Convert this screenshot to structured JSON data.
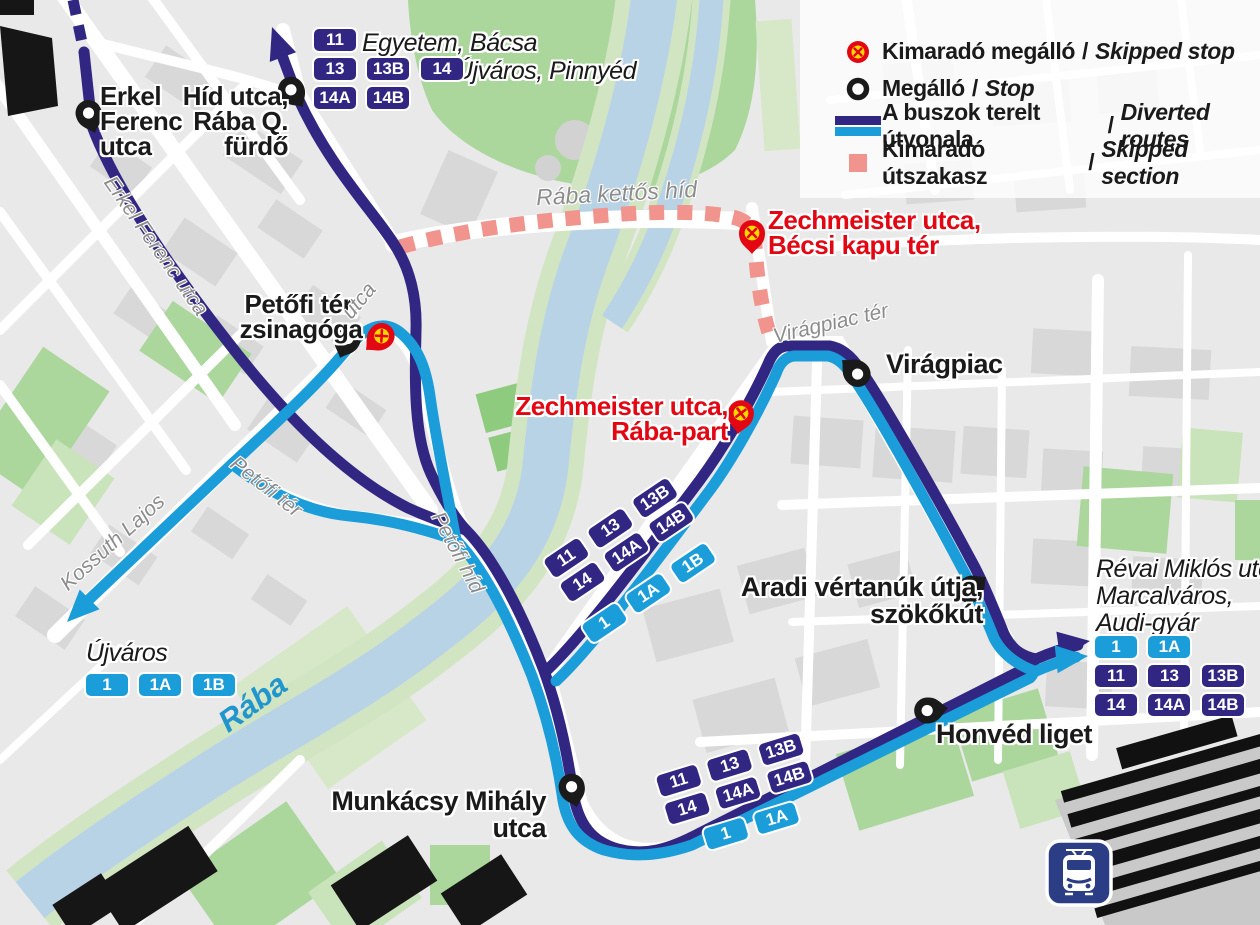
{
  "legend": {
    "sep": "/",
    "items": [
      {
        "hu": "Kimaradó megálló",
        "en": "Skipped stop"
      },
      {
        "hu": "Megálló",
        "en": "Stop"
      },
      {
        "hu": "A buszok terelt útvonala",
        "en": "Diverted routes"
      },
      {
        "hu": "Kimaradó útszakasz",
        "en": "Skipped section"
      }
    ]
  },
  "stops": {
    "erkel": {
      "lines": [
        "Erkel",
        "Ferenc",
        "utca"
      ]
    },
    "hid_utca": {
      "lines": [
        "Híd utca,",
        "Rába Q.",
        "fürdő"
      ]
    },
    "zsinagoga": {
      "lines": [
        "Petőfi tér,",
        "zsinagóga"
      ]
    },
    "viragpiac": {
      "label": "Virágpiac"
    },
    "aradi": {
      "lines": [
        "Aradi vértanúk útja,",
        "szökőkút"
      ]
    },
    "honved": {
      "label": "Honvéd liget"
    },
    "munkacsy": {
      "lines": [
        "Munkácsy Mihály",
        "utca"
      ]
    }
  },
  "skipped_stops": {
    "becsi_kapu": {
      "lines": [
        "Zechmeister utca,",
        "Bécsi kapu tér"
      ]
    },
    "raba_part": {
      "lines": [
        "Zechmeister utca,",
        "Rába-part"
      ]
    }
  },
  "destinations": {
    "north1": "Egyetem, Bácsa",
    "north2": "Újváros, Pinnyéd",
    "southwest": "Újváros",
    "east": {
      "lines": [
        "Révai Miklós utca,",
        "Marcalváros,",
        "Audi-gyár"
      ]
    }
  },
  "street_labels": {
    "erkel_ferenc": "Erkel Ferenc utca",
    "raba_kettos_hid": "Rába kettős híd",
    "viragpiac_ter": "Virágpiac tér",
    "petofi_ter": "Petőfi tér",
    "kossuth_lajos": "Kossuth Lajos",
    "petofi_hid": "Petőfi híd",
    "utca": "utca",
    "river": "Rába"
  },
  "badges": {
    "top": {
      "row1": [
        "11"
      ],
      "row2": [
        "13",
        "13B",
        "14"
      ],
      "row3": [
        "14A",
        "14B"
      ]
    },
    "mid_dark": {
      "row1": [
        "11",
        "13",
        "13B"
      ],
      "row2": [
        "14",
        "14A",
        "14B"
      ]
    },
    "mid_light": {
      "row1": [
        "1",
        "1A",
        "1B"
      ]
    },
    "right": {
      "light": [
        "1",
        "1A"
      ],
      "dark1": [
        "11",
        "13",
        "13B"
      ],
      "dark2": [
        "14",
        "14A",
        "14B"
      ]
    },
    "bottom_dark": {
      "row1": [
        "11",
        "13",
        "13B"
      ],
      "row2": [
        "14",
        "14A",
        "14B"
      ]
    },
    "bottom_light": {
      "row1": [
        "1",
        "1A"
      ]
    },
    "ujvaros": {
      "row1": [
        "1",
        "1A",
        "1B"
      ]
    }
  },
  "colors": {
    "dark_route": "#312783",
    "light_route": "#1b9dd9",
    "skipped_section": "#f0948d",
    "skipped_stop_red": "#e30613",
    "skipped_stop_yellow": "#ffd800",
    "river": "#b9d3e6",
    "park": "#abd69c",
    "street_label": "#8c8c8c"
  },
  "icons": {
    "train": "train-station-icon",
    "skipped_stop": "skipped-stop-icon",
    "stop": "stop-icon"
  }
}
